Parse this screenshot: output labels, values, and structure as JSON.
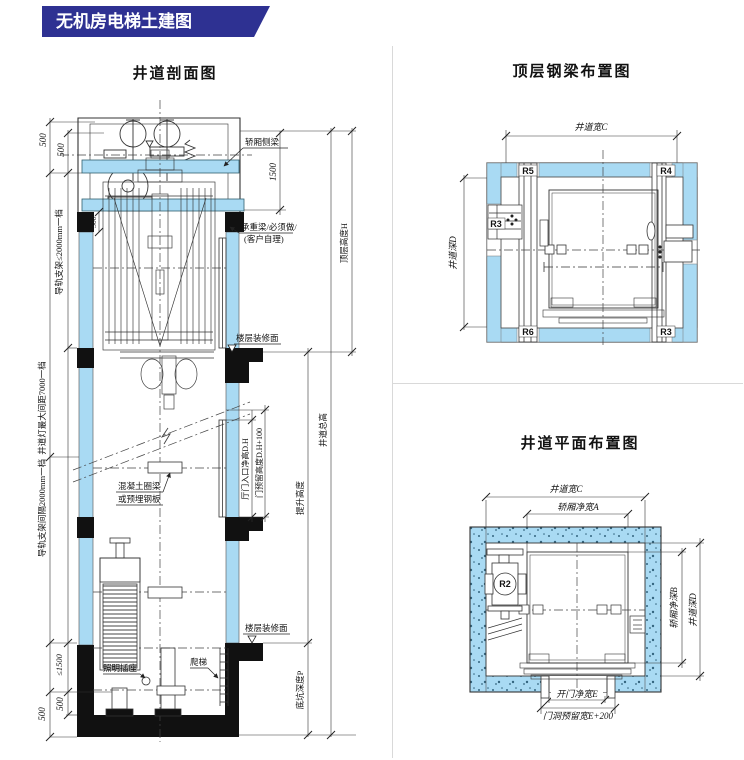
{
  "banner": {
    "title": "无机房电梯土建图"
  },
  "colors": {
    "banner_blue": "#2e3192",
    "wall_blue": "#a9daf3",
    "line_dark": "#333333",
    "slab_black": "#111111"
  },
  "section": {
    "title": "井道剖面图",
    "dims": {
      "d500a": "500",
      "d500b": "500",
      "d300": "300",
      "d1500": "1500",
      "guide_top": "导轨支架≤2000mm一档",
      "light_spacing": "井道灯最大间距7000一档",
      "guide_mid": "导轨支架间隔2000mm一档",
      "le1500": "≤1500",
      "d500c": "500",
      "d500d": "500",
      "top_height": "顶层高度H",
      "total_height": "井道总高",
      "travel_height": "提升高度",
      "pit_depth": "底坑深度P",
      "door_clear": "厅门入口净高D.H",
      "door_reserve": "门预留高度D.H+100"
    },
    "notes": {
      "car_beam": "轿厢侧梁",
      "load_beam1": "承重梁/必须做/",
      "load_beam2": "(客户自理)",
      "floor_finish_u": "楼层装修面",
      "ring1": "混凝土圈梁",
      "ring2": "或预埋钢板",
      "floor_finish_l": "楼层装修面",
      "socket": "照明插座",
      "ladder": "爬梯"
    }
  },
  "beam_plan": {
    "title": "顶层钢梁布置图",
    "dims": {
      "width": "井道宽C",
      "depth": "井道深D"
    },
    "marks": {
      "r5": "R5",
      "r4": "R4",
      "r3l": "R3",
      "r6": "R6",
      "r3b": "R3"
    }
  },
  "shaft_plan": {
    "title": "井道平面布置图",
    "dims": {
      "width": "井道宽C",
      "car_width": "轿厢净宽A",
      "car_depth": "轿厢净深B",
      "depth": "井道深D",
      "door": "开门净宽E",
      "door_reserve": "门洞预留宽E+200"
    },
    "marks": {
      "r2": "R2"
    }
  }
}
